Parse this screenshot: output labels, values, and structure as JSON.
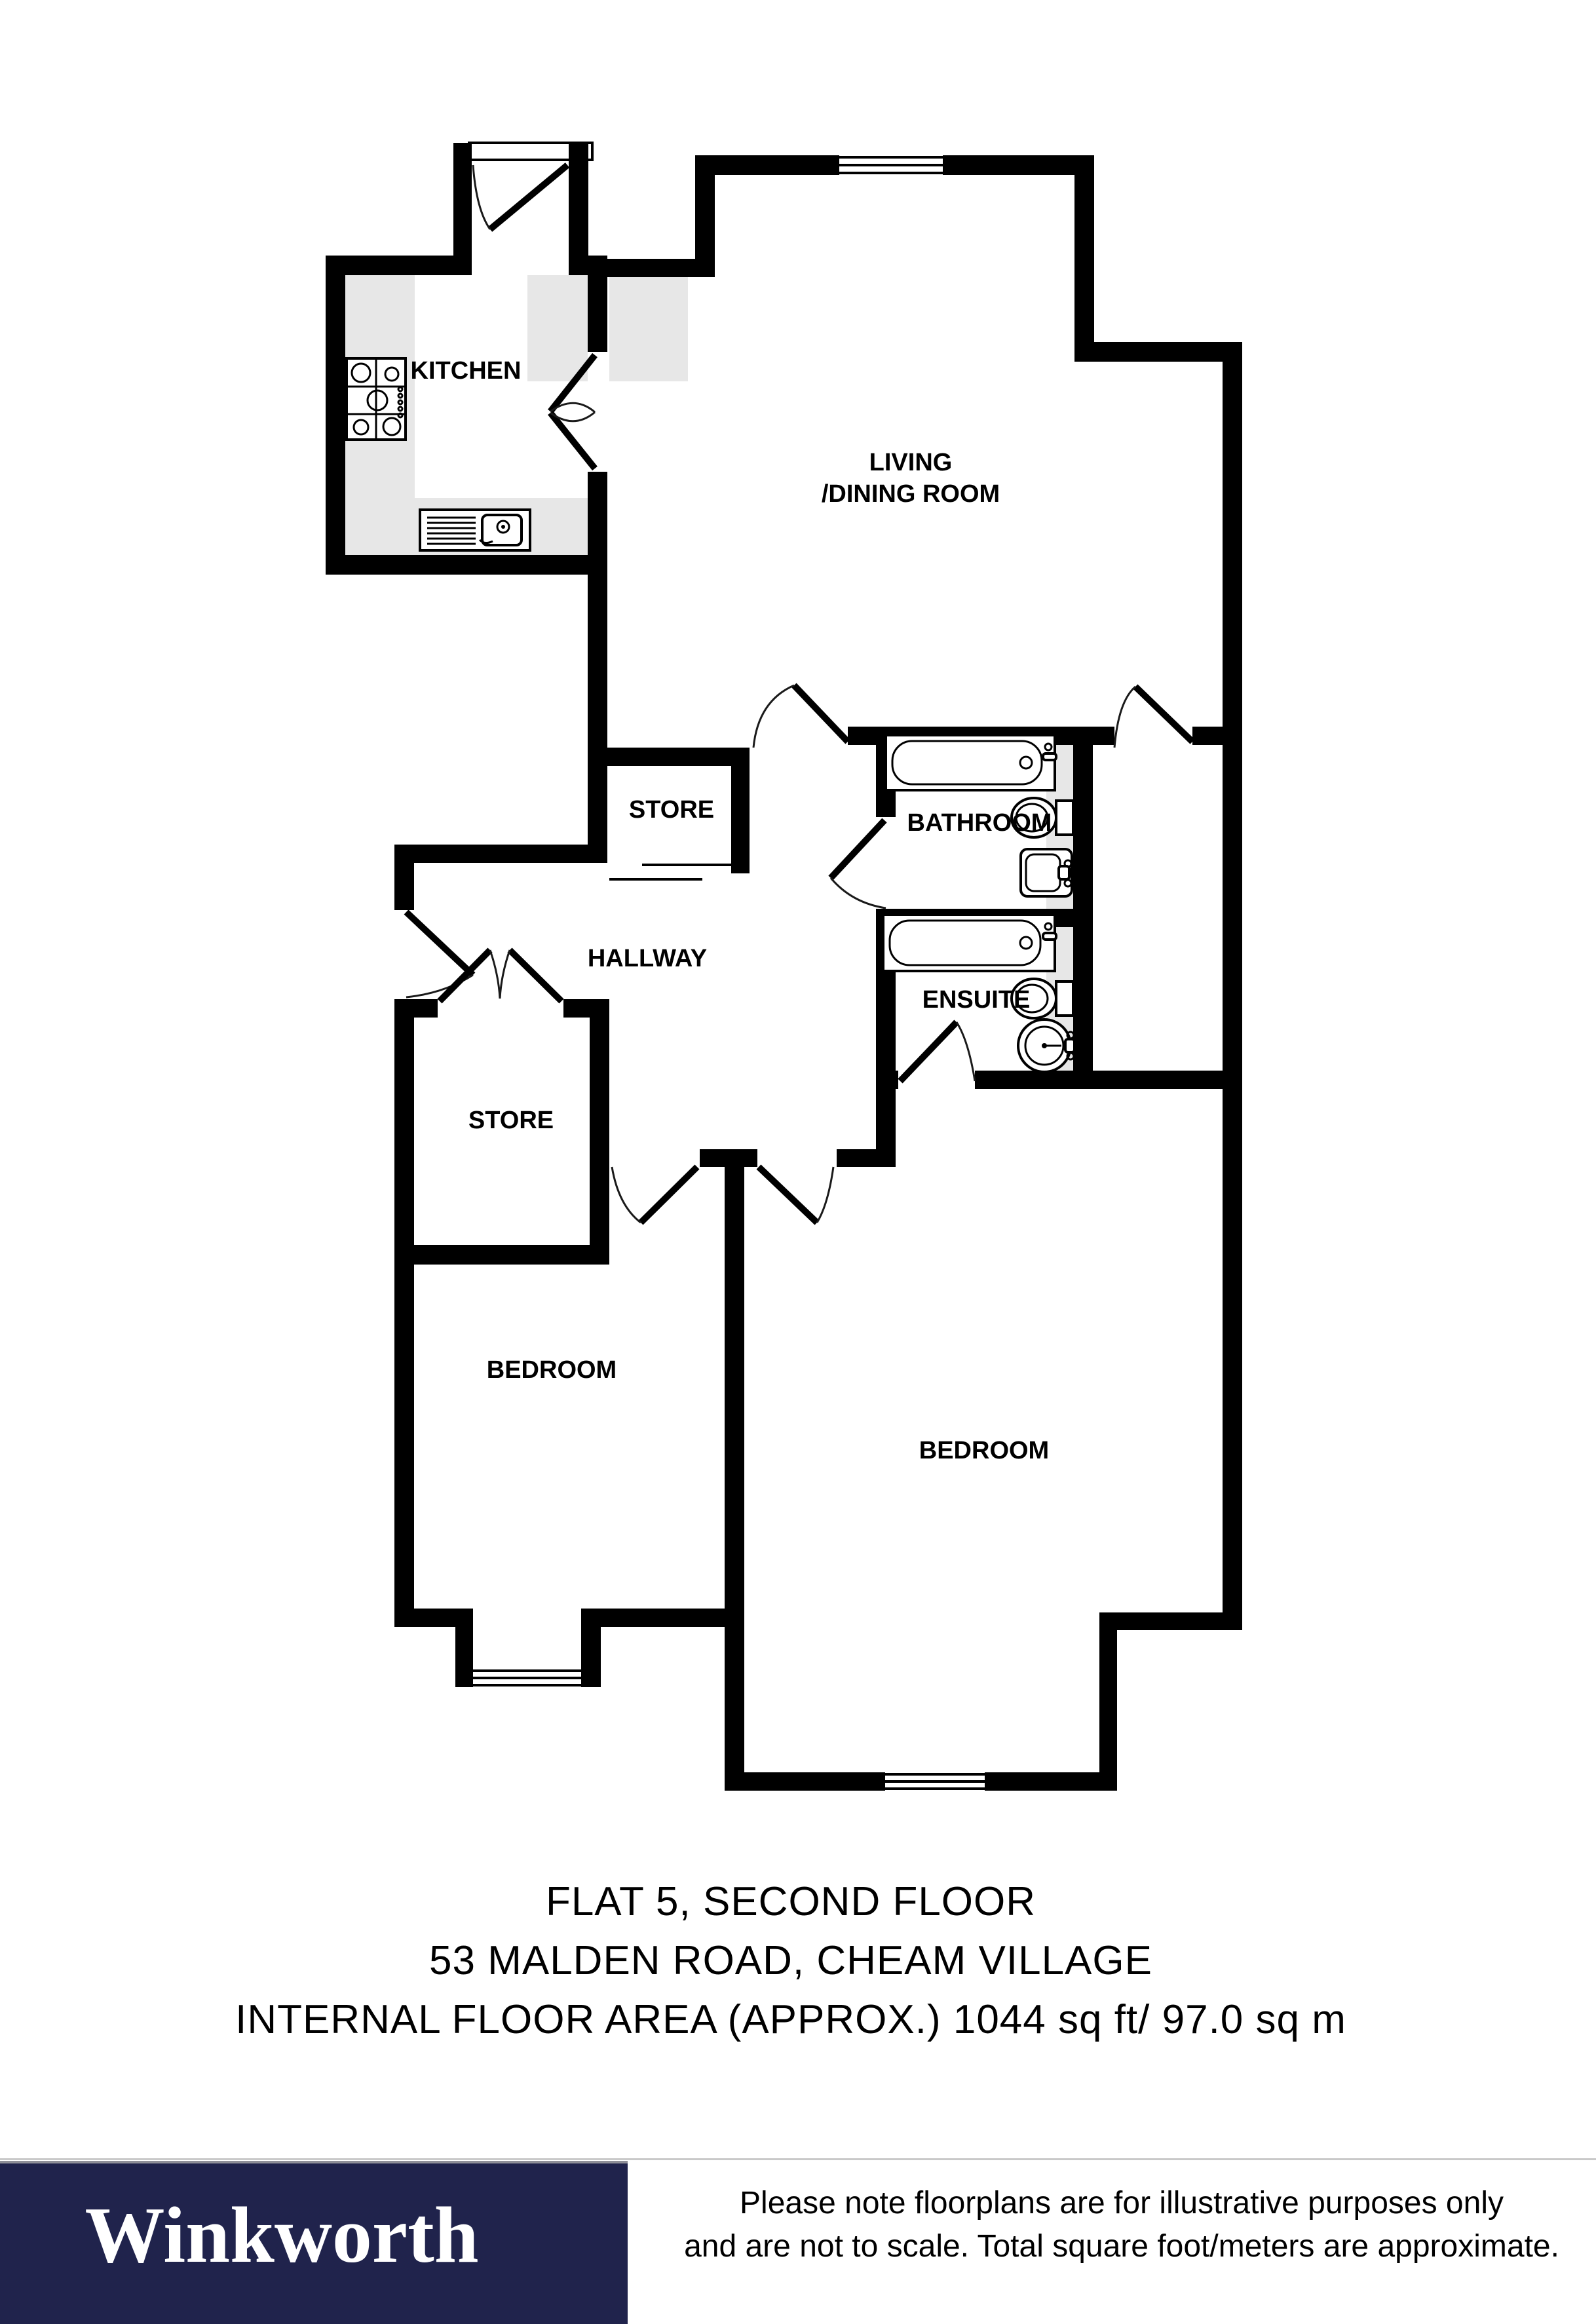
{
  "page": {
    "background": "#ffffff"
  },
  "plan": {
    "rooms": {
      "kitchen": {
        "label": "KITCHEN"
      },
      "living_dining": {
        "line1": "LIVING",
        "line2": "/DINING ROOM"
      },
      "store_top": {
        "label": "STORE"
      },
      "hallway": {
        "label": "HALLWAY"
      },
      "bathroom": {
        "label": "BATHROOM"
      },
      "store_bottom": {
        "label": "STORE"
      },
      "ensuite": {
        "label": "ENSUITE"
      },
      "bedroom_left": {
        "label": "BEDROOM"
      },
      "bedroom_right": {
        "label": "BEDROOM"
      }
    },
    "colors": {
      "wall": "#000000",
      "counter": "#e7e7e7",
      "background": "#ffffff"
    }
  },
  "caption": {
    "line1": "FLAT 5, SECOND FLOOR",
    "line2": "53 MALDEN ROAD, CHEAM VILLAGE",
    "line3": "INTERNAL FLOOR AREA (APPROX.) 1044 sq ft/ 97.0 sq m"
  },
  "footer": {
    "brand": "Winkworth",
    "brand_bg": "#20234c",
    "brand_text_color": "#ffffff",
    "note_line1": "Please note floorplans are for illustrative purposes only",
    "note_line2": "and are not to scale. Total square foot/meters are approximate."
  }
}
